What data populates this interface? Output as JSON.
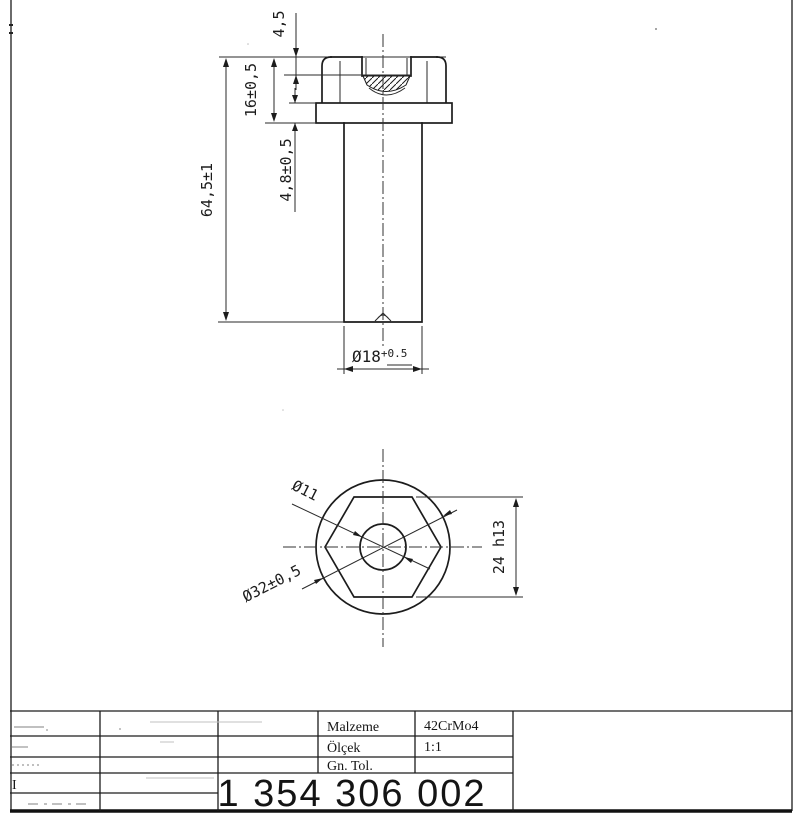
{
  "front_view": {
    "recess_depth": "4,5",
    "head_height": "16±0,5",
    "overall_length": "64,5±1",
    "flange_thickness": "4,8±0,5",
    "shaft_diameter": "Ø18",
    "shaft_diameter_tol": "+0.5"
  },
  "bottom_view": {
    "bore_diameter": "Ø11",
    "flange_diameter": "Ø32±0,5",
    "hex_across_flats": "24 h13"
  },
  "title_block": {
    "material_label": "Malzeme",
    "material_value": "42CrMo4",
    "scale_label": "Ölçek",
    "scale_value": "1:1",
    "tolerance_label": "Gn. Tol.",
    "part_number": "1 354 306 002",
    "revision_mark": "I"
  }
}
